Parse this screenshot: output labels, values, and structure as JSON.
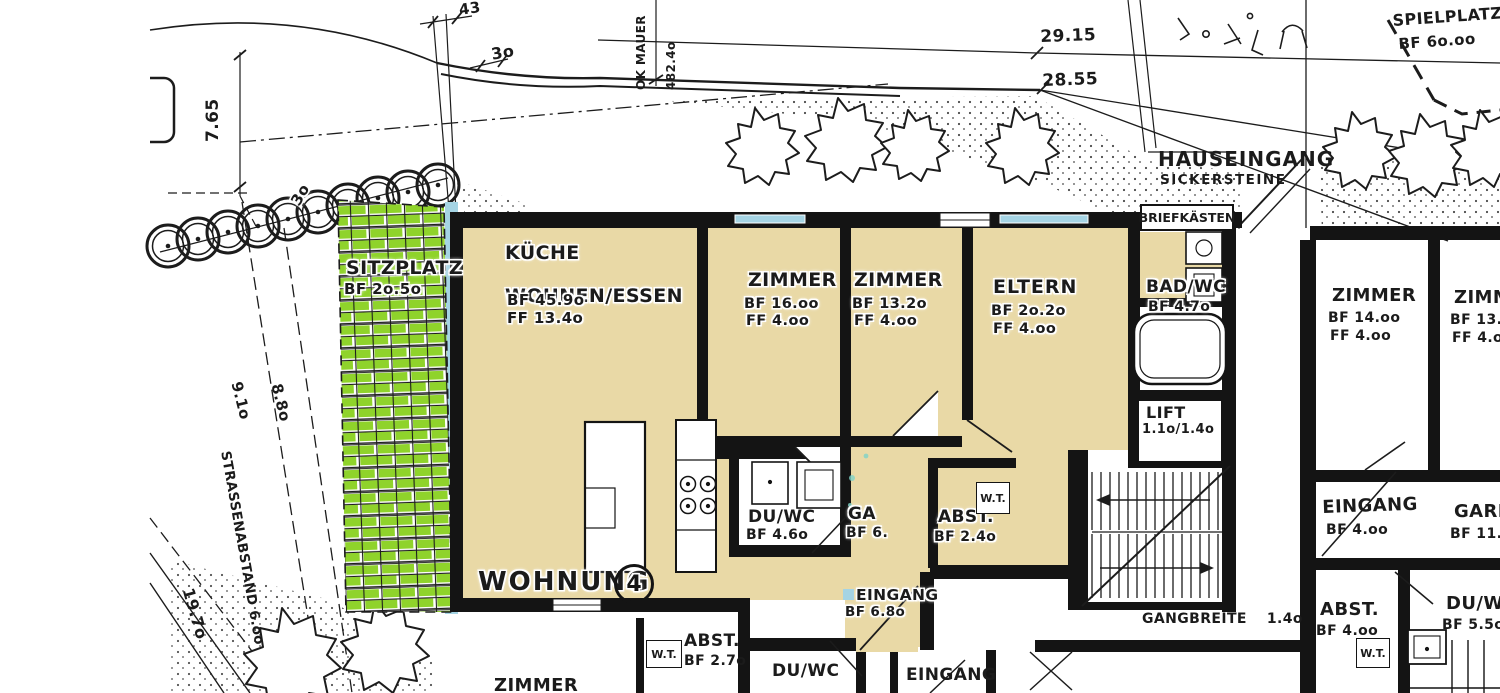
{
  "site": {
    "dims": {
      "d765": "7.65",
      "d43": "43",
      "d30_top": "3o",
      "ok_mauer_l1": "OK MAUER",
      "ok_mauer_l2": "482.4o",
      "d2915": "29.15",
      "d2855": "28.55",
      "tree_30": "3o",
      "d910": "9.1o",
      "d880": "8.8o",
      "strassenabstand": "STRASSENABSTAND 6.oo",
      "d1970": "19.7o"
    },
    "spielplatz": {
      "name": "SPIELPLATZ",
      "bf": "BF 6o.oo"
    },
    "sitzplatz": {
      "name": "SITZPLATZ",
      "bf": "BF 2o.5o"
    },
    "hauseingang": {
      "name": "HAUSEINGANG",
      "sub": "SICKERSTEINE"
    },
    "briefkaesten": "BRIEFKÄSTEN"
  },
  "apartment": {
    "title": "WOHNUNG",
    "number": "4",
    "rooms": [
      {
        "name": "KÜCHE",
        "name2": "WOHNEN/ESSEN",
        "bf": "BF 45.9o",
        "ff": "FF 13.4o"
      },
      {
        "name": "ZIMMER",
        "bf": "BF 16.oo",
        "ff": "FF 4.oo"
      },
      {
        "name": "ZIMMER",
        "bf": "BF 13.2o",
        "ff": "FF 4.oo"
      },
      {
        "name": "ELTERN",
        "bf": "BF 2o.2o",
        "ff": "FF 4.oo"
      },
      {
        "name": "BAD/WC",
        "bf": "BF 4.7o"
      },
      {
        "name": "LIFT",
        "bf": "1.1o/1.4o"
      },
      {
        "name": "DU/WC",
        "bf": "BF 4.6o"
      },
      {
        "name": "GA",
        "bf": "BF 6."
      },
      {
        "name": "ABST.",
        "bf": "BF 2.4o",
        "wt": "W.T."
      },
      {
        "name": "EINGANG",
        "bf": "BF 6.8o"
      }
    ]
  },
  "neighbor_right": {
    "rooms": [
      {
        "name": "ZIMMER",
        "bf": "BF 14.oo",
        "ff": "FF 4.oo"
      },
      {
        "name": "ZIMMER",
        "bf": "BF 13.oo",
        "ff": "FF 4.oo"
      },
      {
        "name": "EINGANG",
        "bf": "BF 4.oo"
      },
      {
        "name": "GARD.",
        "bf": "BF 11.9o"
      },
      {
        "name": "ABST.",
        "bf": "BF 4.oo",
        "wt": "W.T."
      },
      {
        "name": "DU/WC",
        "bf": "BF 5.5o"
      }
    ],
    "gangbreite_label": "GANGBREITE",
    "gangbreite_value": "1.4o"
  },
  "neighbor_bottom": {
    "rooms": [
      {
        "name": "ZIMMER"
      },
      {
        "name": "ABST.",
        "bf": "BF 2.7o",
        "wt": "W.T."
      },
      {
        "name": "DU/WC"
      },
      {
        "name": "EINGANG"
      }
    ]
  },
  "colors": {
    "apartment_fill": "#e9d9a6",
    "sitzplatz_green": "#8fd32b",
    "water_blue": "#a5d4e4",
    "wall": "#141414",
    "paper": "#ffffff"
  }
}
